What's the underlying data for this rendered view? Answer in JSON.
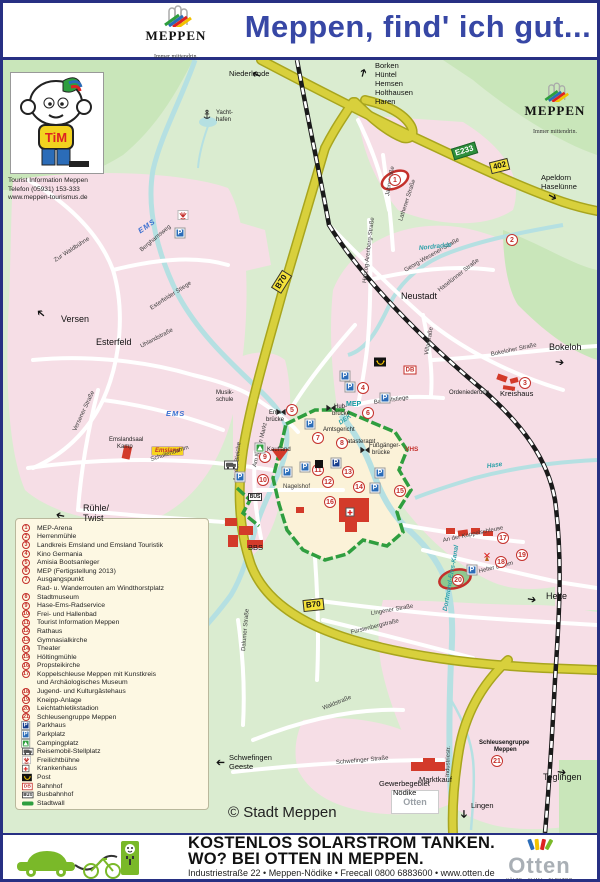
{
  "header": {
    "title": "Meppen, find' ich gut...",
    "logo": {
      "text": "MEPPEN",
      "tagline": "Immer mittendrin."
    }
  },
  "map_logo": {
    "text": "MEPPEN",
    "tagline": "Immer mittendrin."
  },
  "tourist_info": {
    "character": "TiM",
    "line1": "Tourist Information Meppen",
    "line2": "Telefon (05931) 153-333",
    "line3": "www.meppen-tourismus.de"
  },
  "map": {
    "copyright": "© Stadt Meppen",
    "a31": {
      "badge": "A31",
      "dest": "Emden/Oberhausen"
    },
    "brands": {
      "emsland": "Emsland",
      "otten": "Otten"
    },
    "badges": [
      {
        "t": "E233",
        "k": "euro",
        "x": 449,
        "y": 85,
        "r": -17
      },
      {
        "t": "402",
        "k": "b",
        "x": 487,
        "y": 100,
        "r": -14
      },
      {
        "t": "B70",
        "k": "b",
        "x": 268,
        "y": 216,
        "r": -58
      },
      {
        "t": "B70",
        "k": "b",
        "x": 300,
        "y": 539,
        "r": -6
      }
    ],
    "labels": [
      {
        "t": "Niederlande",
        "x": 226,
        "y": 10,
        "c": "dir"
      },
      {
        "t": "Borken",
        "x": 372,
        "y": 2,
        "c": "dir"
      },
      {
        "t": "Hüntel",
        "x": 372,
        "y": 11,
        "c": "dir"
      },
      {
        "t": "Hemsen",
        "x": 372,
        "y": 20,
        "c": "dir"
      },
      {
        "t": "Holthausen",
        "x": 372,
        "y": 29,
        "c": "dir"
      },
      {
        "t": "Haren",
        "x": 372,
        "y": 38,
        "c": "dir"
      },
      {
        "t": "Yacht-",
        "x": 213,
        "y": 50,
        "c": "tiny"
      },
      {
        "t": "hafen",
        "x": 213,
        "y": 57,
        "c": "tiny"
      },
      {
        "t": "Apeldorn",
        "x": 538,
        "y": 114,
        "c": "dir"
      },
      {
        "t": "Haselünne",
        "x": 538,
        "y": 123,
        "c": "dir"
      },
      {
        "t": "Versen",
        "x": 58,
        "y": 255,
        "c": "place"
      },
      {
        "t": "Esterfeld",
        "x": 93,
        "y": 278,
        "c": "place"
      },
      {
        "t": "Neustadt",
        "x": 398,
        "y": 232,
        "c": "place"
      },
      {
        "t": "Bokeloh",
        "x": 546,
        "y": 283,
        "c": "place"
      },
      {
        "t": "Rühle/",
        "x": 80,
        "y": 444,
        "c": "place"
      },
      {
        "t": "Twist",
        "x": 80,
        "y": 454,
        "c": "place"
      },
      {
        "t": "Helte",
        "x": 543,
        "y": 532,
        "c": "place"
      },
      {
        "t": "Teglingen",
        "x": 540,
        "y": 713,
        "c": "place"
      },
      {
        "t": "Lingen",
        "x": 468,
        "y": 742,
        "c": "dir"
      },
      {
        "t": "Schwefingen",
        "x": 226,
        "y": 694,
        "c": "dir"
      },
      {
        "t": "Geeste",
        "x": 226,
        "y": 703,
        "c": "dir"
      },
      {
        "t": "Gewerbegebiet",
        "x": 376,
        "y": 720,
        "c": "dir"
      },
      {
        "t": "Nödike",
        "x": 390,
        "y": 729,
        "c": "dir"
      },
      {
        "t": "Marktkauf",
        "x": 416,
        "y": 716,
        "c": "dir"
      },
      {
        "t": "Schleusengruppe",
        "x": 476,
        "y": 680,
        "c": "tinyb"
      },
      {
        "t": "Meppen",
        "x": 491,
        "y": 687,
        "c": "tinyb"
      },
      {
        "t": "Ordeniederung",
        "x": 446,
        "y": 330,
        "c": "tiny"
      },
      {
        "t": "Kreishaus",
        "x": 497,
        "y": 330,
        "c": "dir"
      },
      {
        "t": "Musik-",
        "x": 213,
        "y": 330,
        "c": "tiny"
      },
      {
        "t": "schule",
        "x": 213,
        "y": 337,
        "c": "tiny"
      },
      {
        "t": "Emslandsaal",
        "x": 106,
        "y": 377,
        "c": "tiny"
      },
      {
        "t": "Kamp",
        "x": 114,
        "y": 384,
        "c": "tiny"
      },
      {
        "t": "Kaufland",
        "x": 264,
        "y": 387,
        "c": "tiny"
      },
      {
        "t": "Nagelshof",
        "x": 280,
        "y": 424,
        "c": "street"
      },
      {
        "t": "BBS",
        "x": 245,
        "y": 484,
        "c": "dir"
      },
      {
        "t": "Amtsgericht",
        "x": 320,
        "y": 367,
        "c": "tiny"
      },
      {
        "t": "Katasteramt",
        "x": 340,
        "y": 379,
        "c": "tiny"
      },
      {
        "t": "VHS",
        "x": 402,
        "y": 387,
        "c": "redlbl"
      },
      {
        "t": "Fußgänger-",
        "x": 366,
        "y": 383,
        "c": "tiny"
      },
      {
        "t": "brücke",
        "x": 369,
        "y": 390,
        "c": "tiny"
      },
      {
        "t": "Ems-",
        "x": 266,
        "y": 350,
        "c": "tiny"
      },
      {
        "t": "brücke",
        "x": 263,
        "y": 357,
        "c": "tiny"
      },
      {
        "t": "Hub-",
        "x": 331,
        "y": 344,
        "c": "tiny"
      },
      {
        "t": "brücke",
        "x": 329,
        "y": 351,
        "c": "tiny"
      },
      {
        "t": "Berghamsweg",
        "x": 138,
        "y": 188,
        "c": "street",
        "r": -40
      },
      {
        "t": "Zur Waldbühne",
        "x": 52,
        "y": 198,
        "c": "street",
        "r": -33
      },
      {
        "t": "Esterfelder Stiege",
        "x": 148,
        "y": 246,
        "c": "street",
        "r": -33
      },
      {
        "t": "Uhlandstraße",
        "x": 138,
        "y": 284,
        "c": "street",
        "r": -28
      },
      {
        "t": "Versener Straße",
        "x": 72,
        "y": 368,
        "c": "street",
        "r": -65
      },
      {
        "t": "Schullendamm",
        "x": 148,
        "y": 397,
        "c": "street",
        "r": -18
      },
      {
        "t": "An der Bleiche",
        "x": 233,
        "y": 418,
        "c": "street",
        "r": -85
      },
      {
        "t": "Am Neuen Markt",
        "x": 252,
        "y": 404,
        "c": "street",
        "r": -76
      },
      {
        "t": "Bauhofstiege",
        "x": 371,
        "y": 340,
        "c": "street",
        "r": -8
      },
      {
        "t": "Haselünner Straße",
        "x": 436,
        "y": 228,
        "c": "street",
        "r": -38
      },
      {
        "t": "Georg-Wesener-Straße",
        "x": 402,
        "y": 208,
        "c": "street",
        "r": -30
      },
      {
        "t": "Herzog-Arenberg-Straße",
        "x": 362,
        "y": 220,
        "c": "street",
        "r": -83
      },
      {
        "t": "Villastraße",
        "x": 424,
        "y": 292,
        "c": "street",
        "r": -80
      },
      {
        "t": "Bokeloher Straße",
        "x": 488,
        "y": 292,
        "c": "street",
        "r": -12
      },
      {
        "t": "Lingener Straße",
        "x": 368,
        "y": 551,
        "c": "street",
        "r": -10
      },
      {
        "t": "Fürstenbergstraße",
        "x": 348,
        "y": 570,
        "c": "street",
        "r": -14
      },
      {
        "t": "Helter Damm",
        "x": 476,
        "y": 509,
        "c": "street",
        "r": -14
      },
      {
        "t": "An der Koppelschleuse",
        "x": 440,
        "y": 478,
        "c": "street",
        "r": -12
      },
      {
        "t": "Dalumer Straße",
        "x": 241,
        "y": 588,
        "c": "street",
        "r": -85
      },
      {
        "t": "Waldstraße",
        "x": 320,
        "y": 646,
        "c": "street",
        "r": -22
      },
      {
        "t": "Schwefinger Straße",
        "x": 333,
        "y": 700,
        "c": "street",
        "r": -5
      },
      {
        "t": "Industriestr.",
        "x": 445,
        "y": 714,
        "c": "street",
        "r": -88
      },
      {
        "t": "Jahnstraße",
        "x": 385,
        "y": 133,
        "c": "street",
        "r": -80
      },
      {
        "t": "Lathener Straße",
        "x": 398,
        "y": 158,
        "c": "street",
        "r": -72
      },
      {
        "t": "EMS",
        "x": 136,
        "y": 168,
        "c": "ems",
        "r": -35
      },
      {
        "t": "EMS",
        "x": 163,
        "y": 350,
        "c": "ems"
      },
      {
        "t": "DEK",
        "x": 337,
        "y": 361,
        "c": "water",
        "r": -35
      },
      {
        "t": "MEP",
        "x": 343,
        "y": 341,
        "c": "mep"
      },
      {
        "t": "Nordradde",
        "x": 416,
        "y": 186,
        "c": "water",
        "r": -6
      },
      {
        "t": "Dortmund-Ems-Kanal",
        "x": 443,
        "y": 548,
        "c": "water",
        "r": -80
      },
      {
        "t": "Hase",
        "x": 484,
        "y": 404,
        "c": "water",
        "r": -8
      }
    ],
    "markers": [
      {
        "n": "1",
        "x": 392,
        "y": 120
      },
      {
        "n": "2",
        "x": 509,
        "y": 180
      },
      {
        "n": "3",
        "x": 522,
        "y": 323
      },
      {
        "n": "4",
        "x": 360,
        "y": 328
      },
      {
        "n": "5",
        "x": 289,
        "y": 350
      },
      {
        "n": "6",
        "x": 365,
        "y": 353
      },
      {
        "n": "7",
        "x": 315,
        "y": 378
      },
      {
        "n": "8",
        "x": 339,
        "y": 383
      },
      {
        "n": "9",
        "x": 262,
        "y": 397
      },
      {
        "n": "10",
        "x": 260,
        "y": 420
      },
      {
        "n": "11",
        "x": 315,
        "y": 410
      },
      {
        "n": "12",
        "x": 325,
        "y": 422
      },
      {
        "n": "13",
        "x": 345,
        "y": 412
      },
      {
        "n": "14",
        "x": 356,
        "y": 427
      },
      {
        "n": "15",
        "x": 397,
        "y": 431
      },
      {
        "n": "16",
        "x": 327,
        "y": 442
      },
      {
        "n": "17",
        "x": 500,
        "y": 478
      },
      {
        "n": "18",
        "x": 498,
        "y": 502
      },
      {
        "n": "19",
        "x": 519,
        "y": 495
      },
      {
        "n": "20",
        "x": 455,
        "y": 520
      },
      {
        "n": "21",
        "x": 494,
        "y": 701
      }
    ],
    "icons": [
      {
        "k": "parkplatz",
        "x": 177,
        "y": 173
      },
      {
        "k": "parkplatz",
        "x": 342,
        "y": 316
      },
      {
        "k": "parkplatz",
        "x": 347,
        "y": 327
      },
      {
        "k": "parkplatz",
        "x": 382,
        "y": 338
      },
      {
        "k": "parkplatz",
        "x": 307,
        "y": 364
      },
      {
        "k": "parkplatz",
        "x": 284,
        "y": 412
      },
      {
        "k": "parkplatz",
        "x": 302,
        "y": 407
      },
      {
        "k": "parkplatz",
        "x": 377,
        "y": 413
      },
      {
        "k": "parkplatz",
        "x": 372,
        "y": 428
      },
      {
        "k": "parkplatz",
        "x": 237,
        "y": 417
      },
      {
        "k": "parkplatz",
        "x": 469,
        "y": 510
      },
      {
        "k": "parkhaus",
        "x": 333,
        "y": 403
      },
      {
        "k": "post",
        "x": 377,
        "y": 302
      },
      {
        "k": "db",
        "x": 407,
        "y": 310
      },
      {
        "k": "bus",
        "x": 252,
        "y": 437
      },
      {
        "k": "rv",
        "x": 228,
        "y": 405
      },
      {
        "k": "camping",
        "x": 257,
        "y": 388
      },
      {
        "k": "openair",
        "x": 180,
        "y": 155
      },
      {
        "k": "anchor",
        "x": 204,
        "y": 55
      },
      {
        "k": "bridge",
        "x": 278,
        "y": 352
      },
      {
        "k": "bridge",
        "x": 328,
        "y": 348
      },
      {
        "k": "bridge",
        "x": 362,
        "y": 390
      },
      {
        "k": "civic",
        "x": 316,
        "y": 404
      },
      {
        "k": "mill",
        "x": 484,
        "y": 497
      },
      {
        "k": "hospital",
        "x": 347,
        "y": 452
      }
    ],
    "arrows": [
      {
        "x": 258,
        "y": 10,
        "r": -155
      },
      {
        "x": 360,
        "y": 12,
        "r": -75
      },
      {
        "x": 545,
        "y": 130,
        "r": 28
      },
      {
        "x": 552,
        "y": 297,
        "r": 8
      },
      {
        "x": 42,
        "y": 250,
        "r": -140
      },
      {
        "x": 62,
        "y": 450,
        "r": -168
      },
      {
        "x": 524,
        "y": 534,
        "r": 10
      },
      {
        "x": 554,
        "y": 707,
        "r": 8
      },
      {
        "x": 460,
        "y": 744,
        "r": 90
      },
      {
        "x": 222,
        "y": 696,
        "r": 180
      }
    ]
  },
  "legend": {
    "numbered": [
      {
        "n": "1",
        "label": "MEP-Arena"
      },
      {
        "n": "2",
        "label": "Herrenmühle"
      },
      {
        "n": "3",
        "label": "Landkreis Emsland und Emsland Touristik"
      },
      {
        "n": "4",
        "label": "Kino Germania"
      },
      {
        "n": "5",
        "label": "Amisia Bootsanleger"
      },
      {
        "n": "6",
        "label": "MEP (Fertigstellung 2013)"
      },
      {
        "n": "7",
        "label": "Ausgangspunkt",
        "label2": "Rad- u. Wanderrouten am Windthorstplatz"
      },
      {
        "n": "8",
        "label": "Stadtmuseum"
      },
      {
        "n": "9",
        "label": "Hase-Ems-Radservice"
      },
      {
        "n": "10",
        "label": "Frei- und Hallenbad"
      },
      {
        "n": "11",
        "label": "Tourist Information Meppen"
      },
      {
        "n": "12",
        "label": "Rathaus"
      },
      {
        "n": "13",
        "label": "Gymnasialkirche"
      },
      {
        "n": "14",
        "label": "Theater"
      },
      {
        "n": "15",
        "label": "Höltingmühle"
      },
      {
        "n": "16",
        "label": "Propsteikirche"
      },
      {
        "n": "17",
        "label": "Koppelschleuse Meppen mit Kunstkreis",
        "label2": "und Archäologisches Museum"
      },
      {
        "n": "18",
        "label": "Jugend- und Kulturgästehaus"
      },
      {
        "n": "19",
        "label": "Kneipp-Anlage"
      },
      {
        "n": "20",
        "label": "Leichtathletikstadion"
      },
      {
        "n": "21",
        "label": "Schleusengruppe Meppen"
      }
    ],
    "symbols": [
      {
        "k": "parkhaus",
        "label": "Parkhaus"
      },
      {
        "k": "parkplatz",
        "label": "Parkplatz"
      },
      {
        "k": "camping",
        "label": "Campingplatz"
      },
      {
        "k": "rv",
        "label": "Reisemobil-Stellplatz"
      },
      {
        "k": "openair",
        "label": "Freilichtbühne"
      },
      {
        "k": "hospital",
        "label": "Krankenhaus"
      },
      {
        "k": "post",
        "label": "Post"
      },
      {
        "k": "db",
        "label": "Bahnhof"
      },
      {
        "k": "bus",
        "label": "Busbahnhof"
      },
      {
        "k": "wall",
        "label": "Stadtwall"
      }
    ]
  },
  "footer": {
    "headline1": "KOSTENLOS SOLARSTROM TANKEN.",
    "headline2": "WO? BEI OTTEN IN MEPPEN.",
    "address": "Industriestraße 22 • Meppen-Nödike • Freecall 0800 6883600 • www.otten.de",
    "brand": "Otten",
    "brand_tagline": "KÄLTE · KLIMA · ELEKTRO"
  }
}
